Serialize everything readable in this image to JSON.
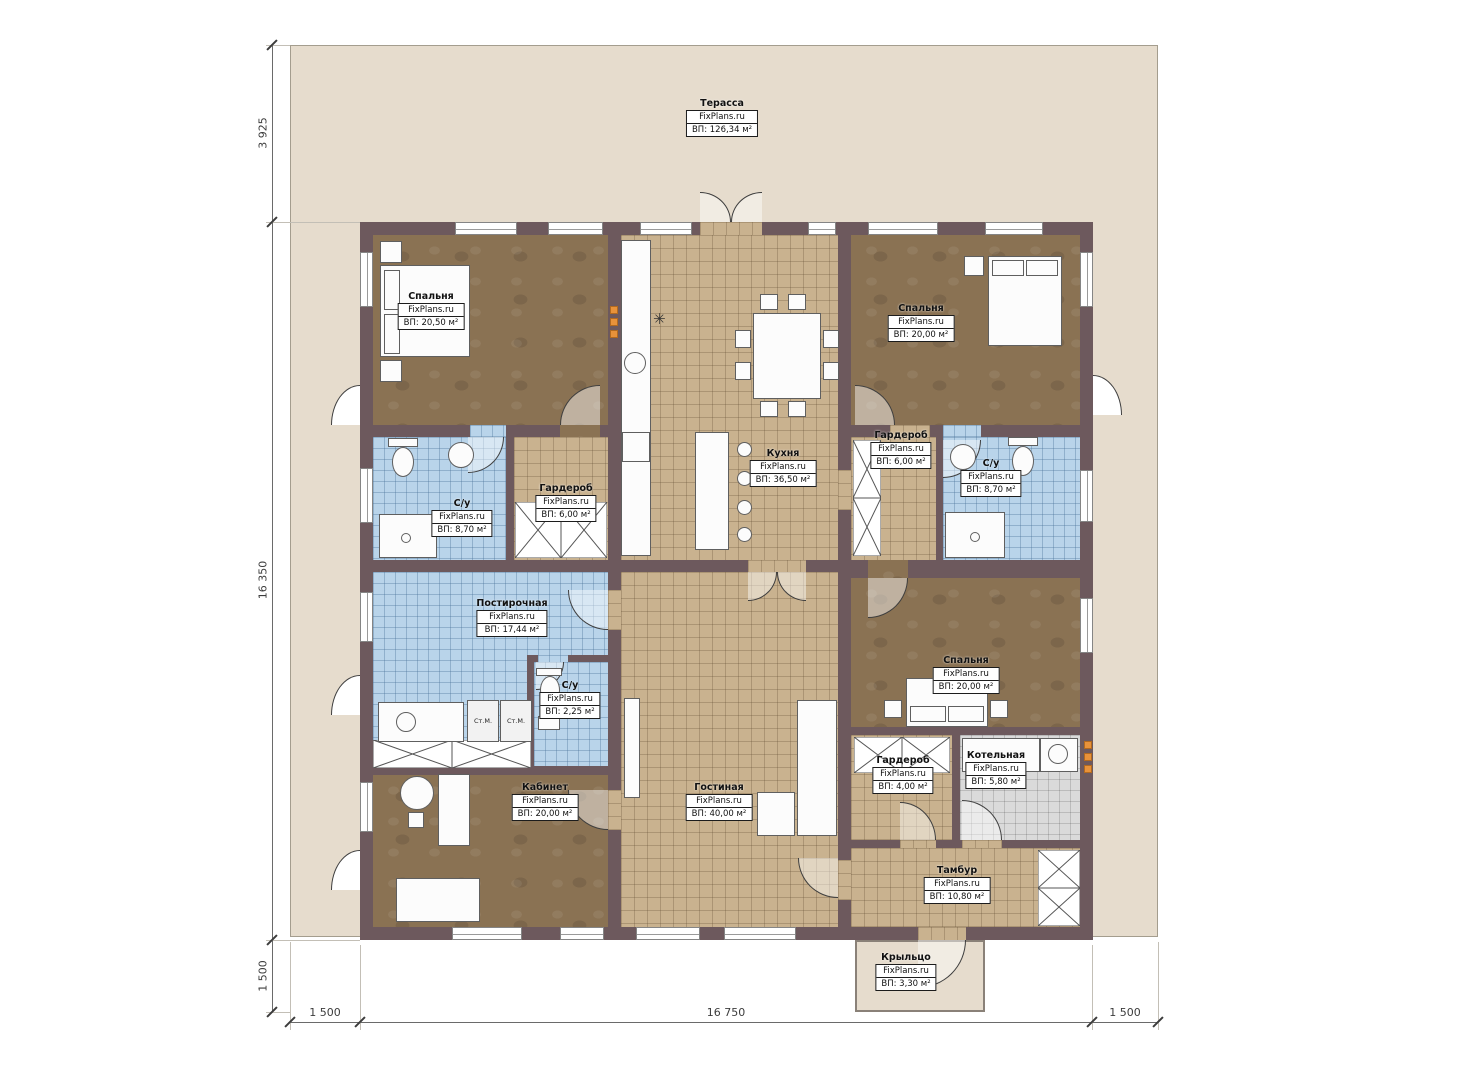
{
  "brand": "FixPlans.ru",
  "rooms": {
    "terrace": {
      "name": "Терасса",
      "brand": "FixPlans.ru",
      "area": "ВП: 126,34 м²"
    },
    "bedroom_tl": {
      "name": "Спальня",
      "brand": "FixPlans.ru",
      "area": "ВП: 20,50 м²"
    },
    "bedroom_tr": {
      "name": "Спальня",
      "brand": "FixPlans.ru",
      "area": "ВП: 20,00 м²"
    },
    "kitchen": {
      "name": "Кухня",
      "brand": "FixPlans.ru",
      "area": "ВП: 36,50 м²"
    },
    "bath_left": {
      "name": "С/у",
      "brand": "FixPlans.ru",
      "area": "ВП: 8,70 м²"
    },
    "wardrobe_left": {
      "name": "Гардероб",
      "brand": "FixPlans.ru",
      "area": "ВП: 6,00 м²"
    },
    "wardrobe_right": {
      "name": "Гардероб",
      "brand": "FixPlans.ru",
      "area": "ВП: 6,00 м²"
    },
    "bath_right": {
      "name": "С/у",
      "brand": "FixPlans.ru",
      "area": "ВП: 8,70 м²"
    },
    "laundry": {
      "name": "Постирочная",
      "brand": "FixPlans.ru",
      "area": "ВП: 17,44 м²"
    },
    "bath_small": {
      "name": "С/у",
      "brand": "FixPlans.ru",
      "area": "ВП: 2,25 м²"
    },
    "bedroom_mid": {
      "name": "Спальня",
      "brand": "FixPlans.ru",
      "area": "ВП: 20,00 м²"
    },
    "wardrobe_small": {
      "name": "Гардероб",
      "brand": "FixPlans.ru",
      "area": "ВП: 4,00 м²"
    },
    "boiler": {
      "name": "Котельная",
      "brand": "FixPlans.ru",
      "area": "ВП: 5,80 м²"
    },
    "office": {
      "name": "Кабинет",
      "brand": "FixPlans.ru",
      "area": "ВП: 20,00 м²"
    },
    "living": {
      "name": "Гостиная",
      "brand": "FixPlans.ru",
      "area": "ВП: 40,00 м²"
    },
    "vestibule": {
      "name": "Тамбур",
      "brand": "FixPlans.ru",
      "area": "ВП: 10,80 м²"
    },
    "porch": {
      "name": "Крыльцо",
      "brand": "FixPlans.ru",
      "area": "ВП: 3,30 м²"
    }
  },
  "dimensions": {
    "left_top": "3 925",
    "left_middle": "16 350",
    "left_bottom": "1 500",
    "bottom_left": "1 500",
    "bottom_middle": "16 750",
    "bottom_right": "1 500"
  },
  "labels": {
    "washer": "Ст.М."
  },
  "icons": {
    "fridge_snowflake": "✳"
  },
  "colors": {
    "wall": "#6d595d",
    "plot": "#e6dccd",
    "wood_floor": "#8a7253",
    "tile_tan": "#c9b28f",
    "tile_blue": "#b9d4ea",
    "tile_gray": "#dadada",
    "vent_orange": "#e8923a"
  }
}
